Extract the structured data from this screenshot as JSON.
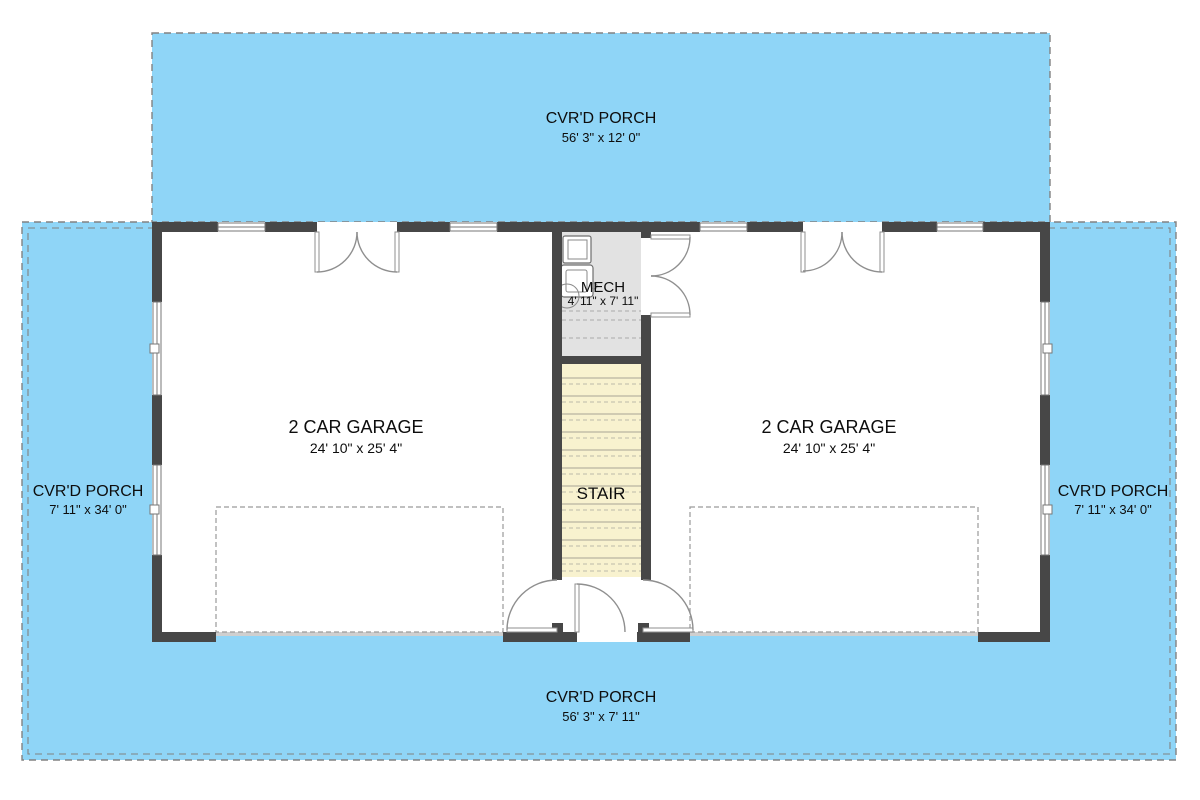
{
  "plan_type": "first-floor-garage-plan",
  "rooms": {
    "top_porch": {
      "label": "CVR'D PORCH",
      "dims": "56' 3\" x 12' 0\""
    },
    "left_porch": {
      "label": "CVR'D PORCH",
      "dims": "7' 11\" x 34' 0\""
    },
    "right_porch": {
      "label": "CVR'D PORCH",
      "dims": "7' 11\" x 34' 0\""
    },
    "bottom_porch": {
      "label": "CVR'D PORCH",
      "dims": "56' 3\" x 7' 11\""
    },
    "left_garage": {
      "label": "2 CAR GARAGE",
      "dims": "24' 10\" x 25' 4\""
    },
    "right_garage": {
      "label": "2 CAR GARAGE",
      "dims": "24' 10\" x 25' 4\""
    },
    "mech": {
      "label": "MECH",
      "dims": "4' 11\" x 7' 11\""
    },
    "stair": {
      "label": "STAIR"
    }
  },
  "colors": {
    "porch_fill": "#8FD5F7",
    "wall_fill": "#474747",
    "stair_fill": "#F8F2CF",
    "mech_fill": "#E2E2E2",
    "text": "#0d0d0d"
  }
}
